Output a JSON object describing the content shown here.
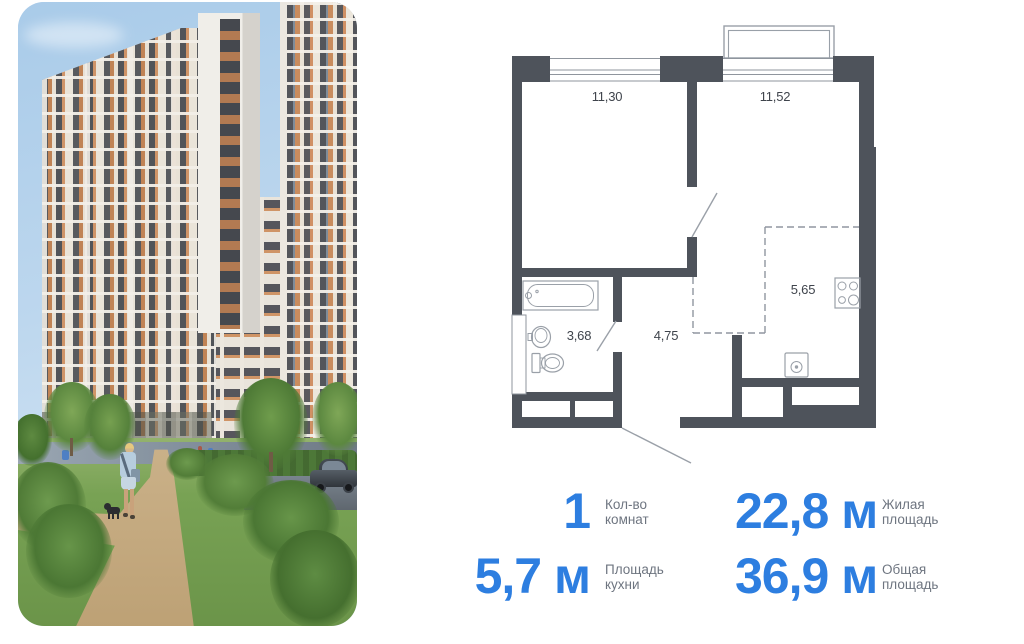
{
  "photo": {
    "scene": [
      "residential-towers",
      "courtyard-path",
      "person-walking-dog",
      "parked-car",
      "lawn-and-bushes",
      "road"
    ]
  },
  "floorplan": {
    "wall_color": "#4e535b",
    "line_color": "#9aa0a8",
    "rooms": [
      {
        "name": "room-1",
        "area": "11,30"
      },
      {
        "name": "room-2",
        "area": "11,52"
      },
      {
        "name": "bathroom",
        "area": "3,68"
      },
      {
        "name": "hallway",
        "area": "4,75"
      },
      {
        "name": "kitchen-niche",
        "area": "5,65"
      }
    ],
    "fixtures": [
      "bathtub",
      "sink",
      "toilet",
      "stove",
      "washer"
    ]
  },
  "stats": {
    "accent_color": "#2d7ee0",
    "label_color": "#6e7580",
    "items": [
      {
        "value": "1",
        "label_line1": "Кол-во",
        "label_line2": "комнат"
      },
      {
        "value": "22,8 м",
        "label_line1": "Жилая",
        "label_line2": "площадь"
      },
      {
        "value": "5,7 м",
        "label_line1": "Площадь",
        "label_line2": "кухни"
      },
      {
        "value": "36,9 м",
        "label_line1": "Общая",
        "label_line2": "площадь"
      }
    ]
  }
}
